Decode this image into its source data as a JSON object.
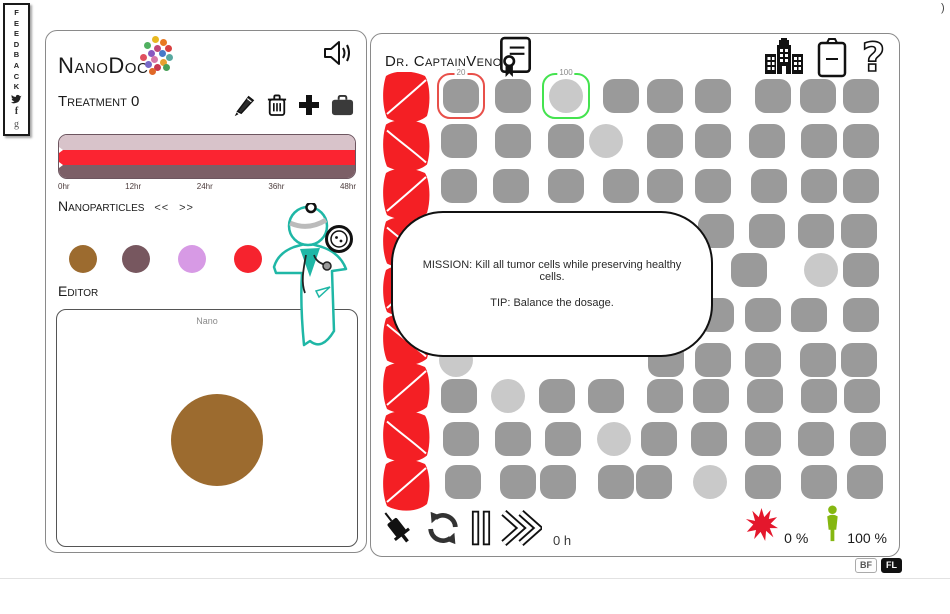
{
  "page": {
    "corner_glyph": ")"
  },
  "feedback_bar": {
    "label": "FEEDBACK",
    "icons": [
      "twitter-bird-icon",
      "facebook-f-icon",
      "google-g-icon"
    ],
    "facebook_glyph": "f",
    "google_glyph": "g"
  },
  "left_panel": {
    "logo": {
      "title": "NanoDoc",
      "dot_colors": [
        "#e8b820",
        "#e87820",
        "#50b060",
        "#d84040",
        "#c04878",
        "#8858c0",
        "#4878c8",
        "#e05060",
        "#58a8a0",
        "#d878a8",
        "#e8a030",
        "#7868c8",
        "#c83850",
        "#48a058",
        "#e06828"
      ]
    },
    "treatment": {
      "label": "Treatment",
      "value": "0"
    },
    "timeline": {
      "ticks": [
        "0hr",
        "12hr",
        "24hr",
        "36hr",
        "48hr"
      ],
      "stripe_colors": {
        "top": "#d8c3ca",
        "middle": "#fb2431",
        "bottom": "#7c5f67"
      }
    },
    "nanoparticles": {
      "label": "Nanoparticles",
      "prev": "<<",
      "next": ">>",
      "palette": [
        "#9c6b2f",
        "#77575f",
        "#d79ae5",
        "#f6232e",
        "#6b6b6b"
      ]
    },
    "editor": {
      "label": "Editor",
      "canvas_title": "Nano",
      "particle_color": "#9c6b2f"
    },
    "icons": [
      "speaker-icon",
      "pencil-icon",
      "trash-icon",
      "add-icon",
      "bag-icon"
    ],
    "mascot_color": "#1fb7a6"
  },
  "right_panel": {
    "title": "Dr. CaptainVenom",
    "icons": [
      "certificate-icon",
      "hospital-icon",
      "clipboard-icon",
      "help-icon"
    ],
    "dialog": {
      "line1": "MISSION: Kill all tumor cells while preserving healthy cells.",
      "line2": "TIP: Balance the dosage."
    },
    "grid": {
      "colors": {
        "healthy": "#9a9a9a",
        "special": "#c9c9c9",
        "vessel": "#f41f24"
      },
      "vessel_segments": 9,
      "marked": [
        {
          "label": "20",
          "shape": "square",
          "x": 90,
          "y": 62,
          "outline": "#e8504a"
        },
        {
          "label": "100",
          "shape": "circle",
          "x": 195,
          "y": 62,
          "outline": "#44e34f"
        }
      ],
      "cells": [
        [
          142,
          62,
          "s"
        ],
        [
          250,
          62,
          "s"
        ],
        [
          294,
          62,
          "s"
        ],
        [
          342,
          62,
          "s"
        ],
        [
          402,
          62,
          "s"
        ],
        [
          447,
          62,
          "s"
        ],
        [
          490,
          62,
          "s"
        ],
        [
          88,
          107,
          "s"
        ],
        [
          142,
          107,
          "s"
        ],
        [
          195,
          107,
          "s"
        ],
        [
          235,
          107,
          "c"
        ],
        [
          294,
          107,
          "s"
        ],
        [
          342,
          107,
          "s"
        ],
        [
          396,
          107,
          "s"
        ],
        [
          448,
          107,
          "s"
        ],
        [
          490,
          107,
          "s"
        ],
        [
          88,
          152,
          "s"
        ],
        [
          140,
          152,
          "s"
        ],
        [
          195,
          152,
          "s"
        ],
        [
          250,
          152,
          "s"
        ],
        [
          294,
          152,
          "s"
        ],
        [
          342,
          152,
          "s"
        ],
        [
          398,
          152,
          "s"
        ],
        [
          448,
          152,
          "s"
        ],
        [
          490,
          152,
          "s"
        ],
        [
          345,
          197,
          "s"
        ],
        [
          396,
          197,
          "s"
        ],
        [
          445,
          197,
          "s"
        ],
        [
          488,
          197,
          "s"
        ],
        [
          378,
          236,
          "s"
        ],
        [
          450,
          236,
          "c"
        ],
        [
          490,
          236,
          "s"
        ],
        [
          345,
          281,
          "s"
        ],
        [
          392,
          281,
          "s"
        ],
        [
          438,
          281,
          "s"
        ],
        [
          490,
          281,
          "s"
        ],
        [
          85,
          326,
          "c"
        ],
        [
          295,
          326,
          "s"
        ],
        [
          342,
          326,
          "s"
        ],
        [
          392,
          326,
          "s"
        ],
        [
          447,
          326,
          "s"
        ],
        [
          488,
          326,
          "s"
        ],
        [
          88,
          362,
          "s"
        ],
        [
          137,
          362,
          "c"
        ],
        [
          186,
          362,
          "s"
        ],
        [
          235,
          362,
          "s"
        ],
        [
          294,
          362,
          "s"
        ],
        [
          340,
          362,
          "s"
        ],
        [
          394,
          362,
          "s"
        ],
        [
          448,
          362,
          "s"
        ],
        [
          491,
          362,
          "s"
        ],
        [
          90,
          405,
          "s"
        ],
        [
          142,
          405,
          "s"
        ],
        [
          192,
          405,
          "s"
        ],
        [
          243,
          405,
          "c"
        ],
        [
          288,
          405,
          "s"
        ],
        [
          338,
          405,
          "s"
        ],
        [
          392,
          405,
          "s"
        ],
        [
          445,
          405,
          "s"
        ],
        [
          497,
          405,
          "s"
        ],
        [
          92,
          448,
          "s"
        ],
        [
          147,
          448,
          "s"
        ],
        [
          187,
          448,
          "s"
        ],
        [
          245,
          448,
          "s"
        ],
        [
          283,
          448,
          "s"
        ],
        [
          339,
          448,
          "c"
        ],
        [
          392,
          448,
          "s"
        ],
        [
          448,
          448,
          "s"
        ],
        [
          494,
          448,
          "s"
        ]
      ]
    },
    "controls": {
      "time": "0 h",
      "icons": [
        "syringe-icon",
        "restart-icon",
        "pause-icon",
        "fast-forward-icon"
      ]
    },
    "hud": {
      "tumor_pct": "0 %",
      "health_pct": "100 %",
      "tumor_color": "#e4172c",
      "health_color": "#85b711",
      "icons": [
        "tumor-splat-icon",
        "person-icon"
      ]
    }
  },
  "footer": {
    "bf": "BF",
    "fl": "FL"
  }
}
